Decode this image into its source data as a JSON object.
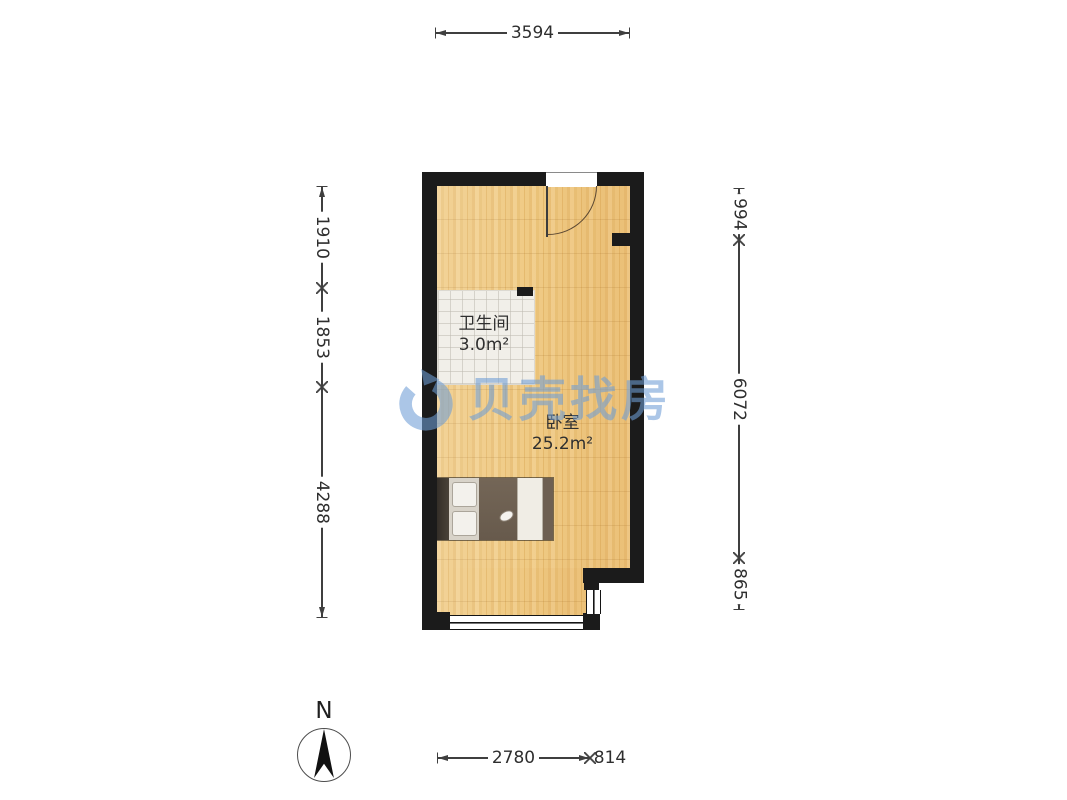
{
  "page": {
    "background": "#ffffff"
  },
  "plan": {
    "rooms": [
      {
        "name": "卫生间",
        "area": "3.0m²"
      },
      {
        "name": "卧室",
        "area": "25.2m²"
      }
    ],
    "dimensions": {
      "top": [
        "3594"
      ],
      "bottom": [
        "2780",
        "814"
      ],
      "left": [
        "1910",
        "1853",
        "4288"
      ],
      "right": [
        "994",
        "6072",
        "865"
      ]
    },
    "colors": {
      "wall": "#1b1b1b",
      "floor_wood": "#eec77f",
      "bathroom_tile": "#f1efe9",
      "dimension_line": "#3f3f3f",
      "watermark_blue": "#6f9ed6",
      "bed_frame_brown": "#6e6052",
      "bed_linen_cream": "#f0ede6"
    }
  },
  "watermark": {
    "logo": "beike-shell-logo",
    "text": "贝壳找房"
  },
  "compass": {
    "label": "N"
  }
}
